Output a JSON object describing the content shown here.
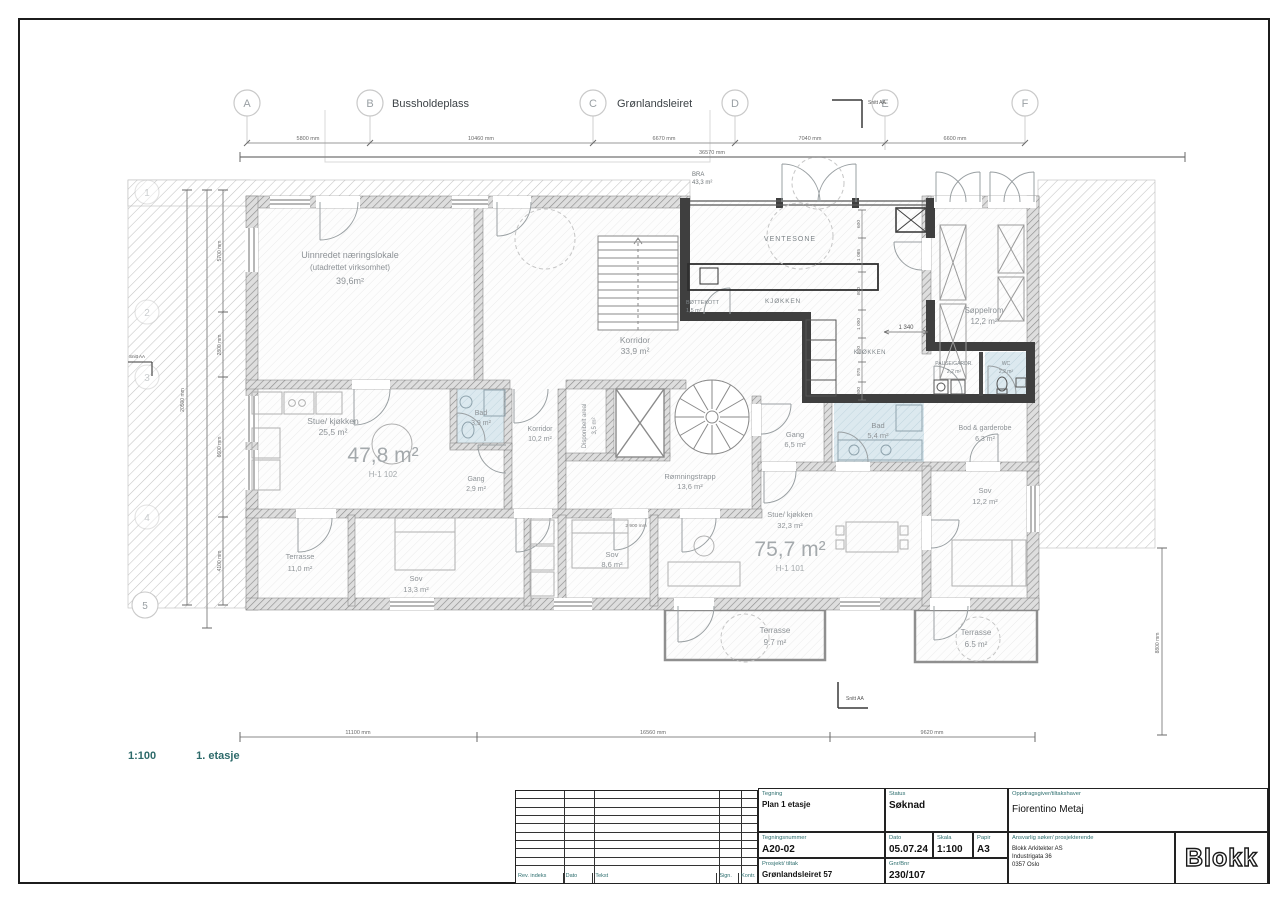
{
  "sheet": {
    "scale": "1:100",
    "floor": "1. etasje",
    "section_marker": "Snitt AA"
  },
  "grid": {
    "top": [
      "A",
      "B",
      "C",
      "D",
      "E",
      "F"
    ],
    "left": [
      "1",
      "2",
      "3",
      "4",
      "5"
    ],
    "street_b": "Bussholdeplass",
    "street_c": "Grønlandsleiret"
  },
  "dims": {
    "top": [
      "5800 mm",
      "10460 mm",
      "6670 mm",
      "7040 mm",
      "6600 mm"
    ],
    "top_total": "36570 mm",
    "bottom": [
      "11100 mm",
      "16560 mm",
      "9620 mm"
    ],
    "left": [
      "5700 mm",
      "2800 mm",
      "6600 mm",
      "4100 mm"
    ],
    "left_total": "20500 mm",
    "right": "8800 mm",
    "kitchen_stack": [
      "600",
      "1 085",
      "800",
      "1 000",
      "800",
      "975",
      "800"
    ],
    "kitchen_width": "1 340",
    "sov_dim": "2 900 mm"
  },
  "bra": {
    "label": "BRA",
    "value": "43,3 m²"
  },
  "apartments": {
    "a102": {
      "area": "47,8 m²",
      "id": "H-1 102"
    },
    "a101": {
      "area": "75,7 m²",
      "id": "H-1 101"
    }
  },
  "rooms": {
    "naering": {
      "l1": "Uinnredet næringslokale",
      "l2": "(utadrettet virksomhet)",
      "l3": "39,6m²"
    },
    "korridor1": {
      "name": "Korridor",
      "area": "33,9 m²"
    },
    "ventesone": {
      "name": "VENTESONE"
    },
    "kjokken1": {
      "name": "KJØKKEN"
    },
    "kjokken2": {
      "name": "KJØKKEN"
    },
    "bottekott": {
      "name": "BØTTEKOTT",
      "area": "1,5 m²"
    },
    "soppelrom": {
      "name": "Søppelrom",
      "area": "12,2 m²"
    },
    "pause": {
      "name": "PAUSE/GARDR.",
      "area": "2,2 m²"
    },
    "wc": {
      "name": "WC",
      "area": "2,2 m²"
    },
    "stue1": {
      "name": "Stue/ kjøkken",
      "area": "25,5 m²"
    },
    "bad1": {
      "name": "Bad",
      "area": "3,9 m²"
    },
    "gang1": {
      "name": "Gang",
      "area": "2,9 m²"
    },
    "korridor2": {
      "name": "Korridor",
      "area": "10,2 m²"
    },
    "disponibelt": {
      "name": "Disponibelt areal",
      "area": "3,5 m²"
    },
    "romningstrapp": {
      "name": "Rømningstrapp",
      "area": "13,6 m²"
    },
    "gang2": {
      "name": "Gang",
      "area": "6,5 m²"
    },
    "bad2": {
      "name": "Bad",
      "area": "5,4 m²"
    },
    "bod": {
      "name": "Bod & garderobe",
      "area": "6,3 m²"
    },
    "sov1": {
      "name": "Sov",
      "area": "12,2 m²"
    },
    "stue2": {
      "name": "Stue/ kjøkken",
      "area": "32,3 m²"
    },
    "sov2": {
      "name": "Sov",
      "area": "8,6 m²"
    },
    "sov3": {
      "name": "Sov",
      "area": "13,3 m²"
    },
    "terrasse1": {
      "name": "Terrasse",
      "area": "11,0 m²"
    },
    "terrasse2": {
      "name": "Terrasse",
      "area": "9.7 m²"
    },
    "terrasse3": {
      "name": "Terrasse",
      "area": "6.5 m²"
    }
  },
  "titleblock": {
    "tegning_label": "Tegning",
    "tegning_value": "Plan 1 etasje",
    "status_label": "Status",
    "status_value": "Søknad",
    "tegningsnummer_label": "Tegningsnummer",
    "tegningsnummer_value": "A20-02",
    "dato_label": "Dato",
    "dato_value": "05.07.24",
    "skala_label": "Skala",
    "skala_value": "1:100",
    "papir_label": "Papir",
    "papir_value": "A3",
    "prosjekt_label": "Prosjekt/ tiltak",
    "prosjekt_value": "Grønlandsleiret 57",
    "gnrbnr_label": "Gnr/Bnr",
    "gnrbnr_value": "230/107",
    "oppdragsgiver_label": "Oppdragsgiver/tiltakshaver",
    "oppdragsgiver_value": "Fiorentino Metaj",
    "ansvarlig_label": "Ansvarlig søker/ prosjekterende",
    "ansvarlig_line1": "Blokk Arkitekter AS",
    "ansvarlig_line2": "Industrigata 36",
    "ansvarlig_line3": "0357 Oslo",
    "logo": "Blokk",
    "rev_headers": [
      "Rev. indeks",
      "Dato",
      "Tekst",
      "Sign.",
      "Kontr."
    ]
  }
}
